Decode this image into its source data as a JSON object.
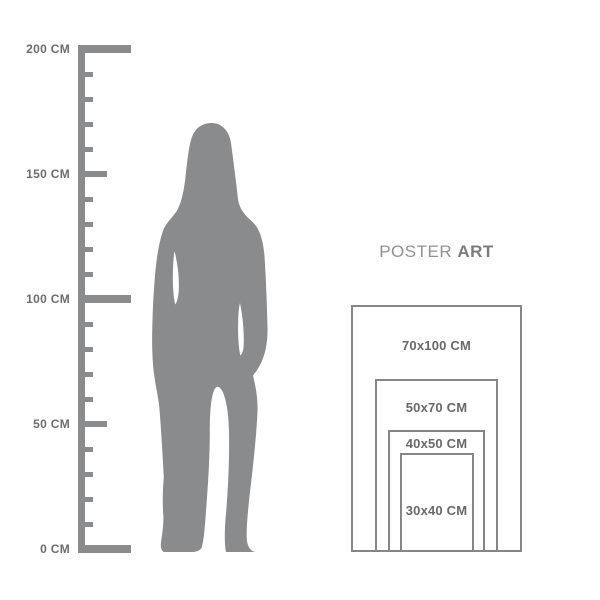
{
  "title": {
    "word_regular": "POSTER",
    "word_bold": "ART"
  },
  "ruler": {
    "unit": "CM",
    "min_cm": 0,
    "max_cm": 200,
    "minor_tick_step_cm": 10,
    "major_tick_step_cm": 50,
    "labels": [
      {
        "cm": 200,
        "text": "200 CM"
      },
      {
        "cm": 150,
        "text": "150 CM"
      },
      {
        "cm": 100,
        "text": "100 CM"
      },
      {
        "cm": 50,
        "text": "50 CM"
      },
      {
        "cm": 0,
        "text": "0 CM"
      }
    ]
  },
  "figure": {
    "type": "standing-woman-silhouette"
  },
  "poster_sizes": [
    {
      "label": "70x100 CM",
      "width_cm": 70,
      "height_cm": 100
    },
    {
      "label": "50x70 CM",
      "width_cm": 50,
      "height_cm": 70
    },
    {
      "label": "40x50 CM",
      "width_cm": 40,
      "height_cm": 50
    },
    {
      "label": "30x40 CM",
      "width_cm": 30,
      "height_cm": 40
    }
  ],
  "colors": {
    "background": "#ffffff",
    "silhouette": "#8a8b8d",
    "ruler": "#8a8b8d",
    "frame_border": "#84868a",
    "label_text": "#66686b",
    "title_regular": "#8f9194",
    "title_bold": "#797b7e"
  }
}
